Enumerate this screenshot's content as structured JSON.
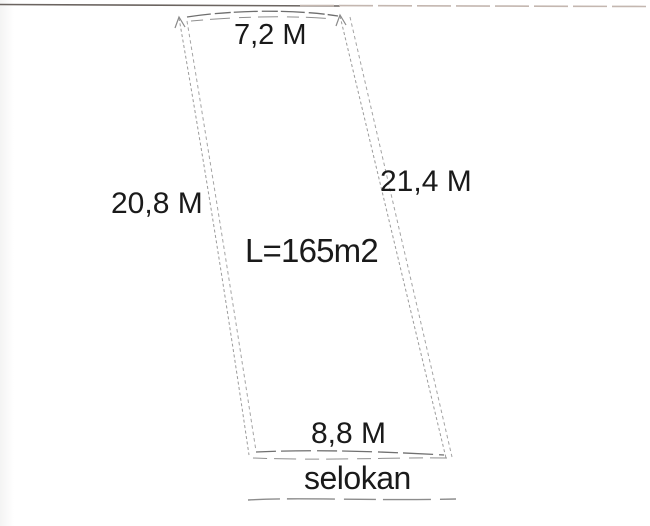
{
  "diagram": {
    "sides": {
      "top": "7,2 M",
      "left": "20,8 M",
      "right": "21,4 M",
      "bottom": "8,8 M"
    },
    "area": "L=165m2",
    "annotation": "selokan"
  },
  "colors": {
    "text": "#1a1a1a",
    "sketch_line_dark": "#6e6e6e",
    "sketch_line_light": "#9b9b9b",
    "scan_line_dark": "#6b6460",
    "scan_line_light": "#c4b7b0",
    "background": "#ffffff"
  }
}
